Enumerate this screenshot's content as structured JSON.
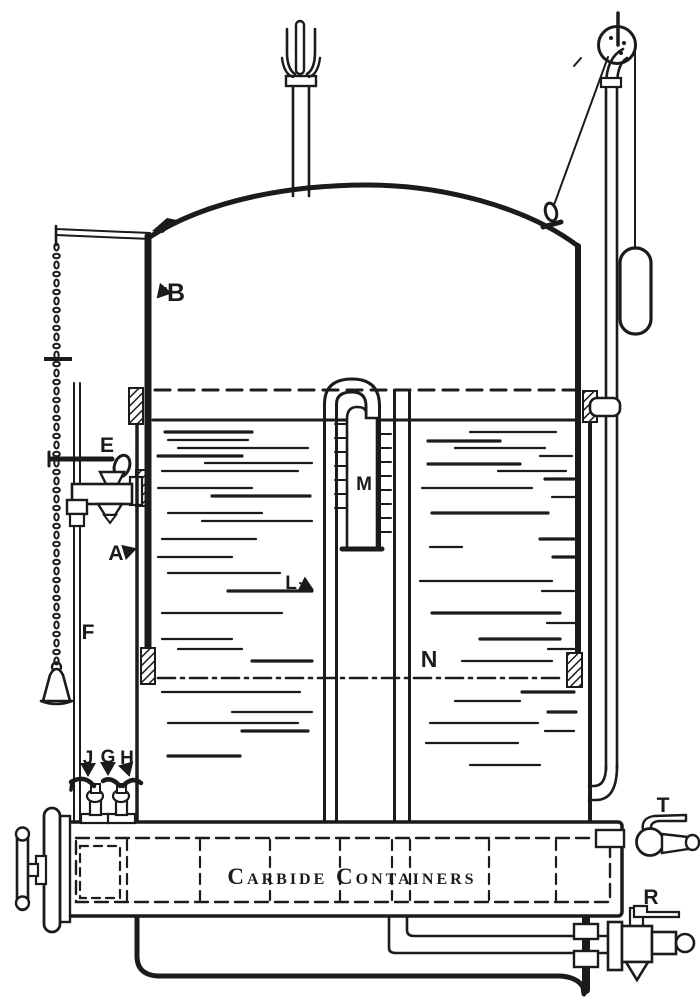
{
  "colors": {
    "ink": "#1b1b1b",
    "paper": "#ffffff"
  },
  "box_label": "Carbide Containers",
  "labels": {
    "bell": "B",
    "tank": "A",
    "water_cock": "E",
    "gauge_pipe": "F",
    "feed_pipe": "L",
    "gauge_tube": "M",
    "down_pipe": "N",
    "cock_j": "J",
    "cock_g": "G",
    "cock_h": "H",
    "top_cock": "T",
    "drain_cock": "R"
  }
}
